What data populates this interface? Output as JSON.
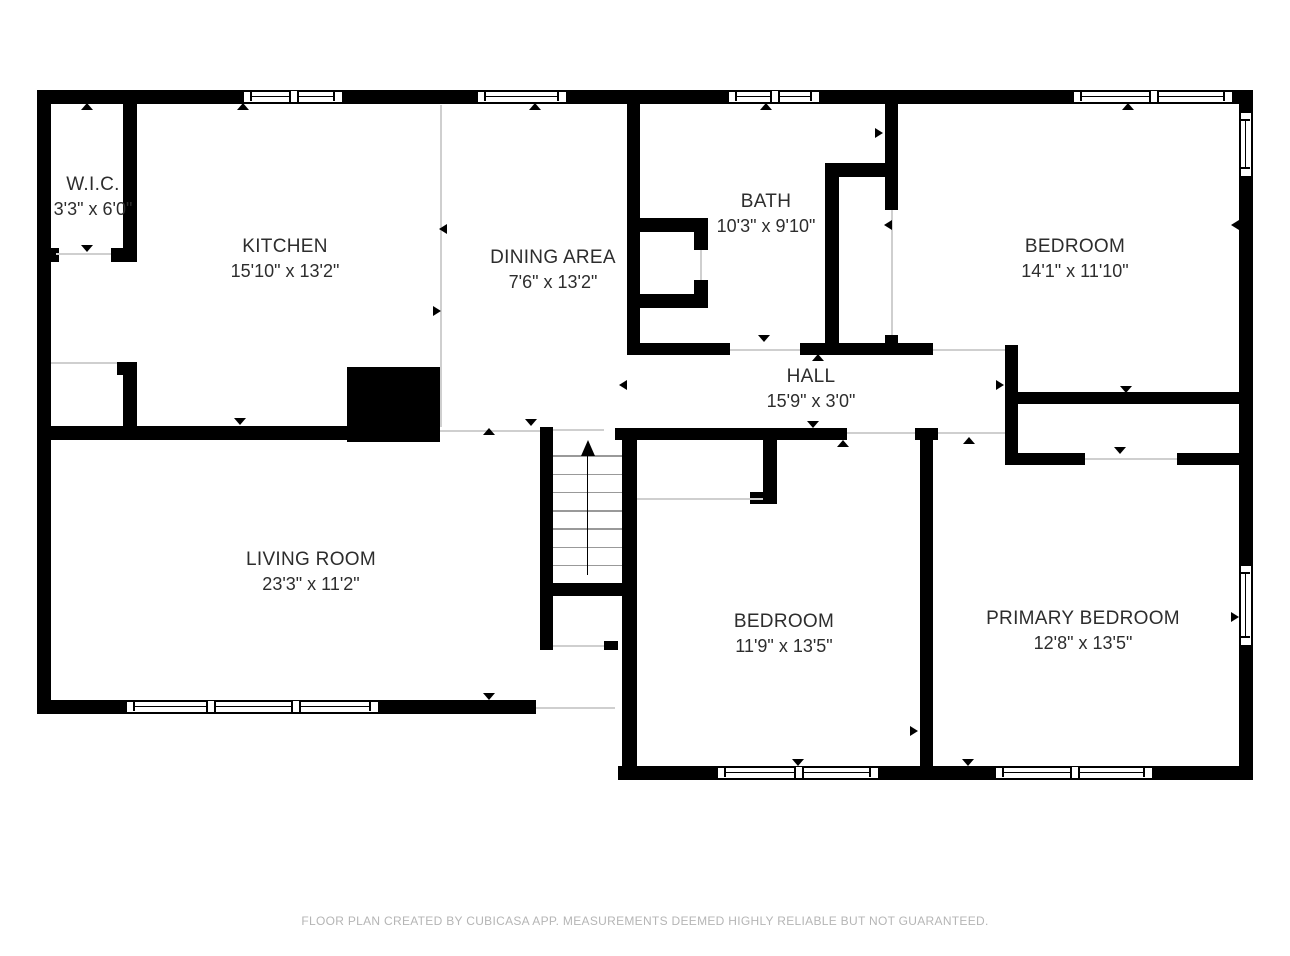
{
  "colors": {
    "wall": "#000000",
    "background": "#ffffff",
    "open_boundary": "#cfcfcf",
    "label_text": "#2d2d2d",
    "footer_text": "#b5b5b5"
  },
  "rooms": [
    {
      "name": "W.I.C.",
      "dims": "3'3\" x 6'0\""
    },
    {
      "name": "KITCHEN",
      "dims": "15'10\" x 13'2\""
    },
    {
      "name": "DINING AREA",
      "dims": "7'6\" x 13'2\""
    },
    {
      "name": "BATH",
      "dims": "10'3\" x 9'10\""
    },
    {
      "name": "BEDROOM",
      "dims": "14'1\" x 11'10\""
    },
    {
      "name": "HALL",
      "dims": "15'9\" x 3'0\""
    },
    {
      "name": "LIVING ROOM",
      "dims": "23'3\" x 11'2\""
    },
    {
      "name": "BEDROOM",
      "dims": "11'9\" x 13'5\""
    },
    {
      "name": "PRIMARY BEDROOM",
      "dims": "12'8\" x 13'5\""
    }
  ],
  "stairs": {
    "icon": "stairs-up-arrow"
  },
  "footer": {
    "disclaimer": "FLOOR PLAN CREATED BY CUBICASA APP. MEASUREMENTS DEEMED HIGHLY RELIABLE BUT NOT GUARANTEED."
  }
}
